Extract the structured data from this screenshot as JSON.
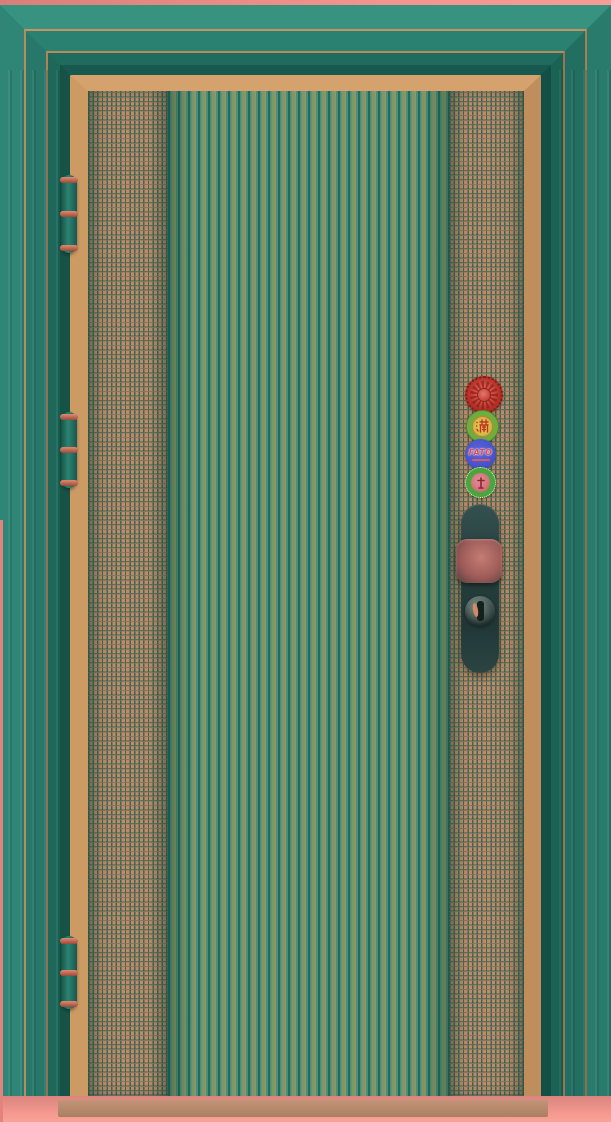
{
  "photo": {
    "subject": "Teal-tinted photograph of a closed bronze security door with ribbed center panel and perforated mesh side strips"
  },
  "door": {
    "panels": {
      "left": "perforated-mesh-strip",
      "center": "vertical-ribbed-panel",
      "right": "perforated-mesh-strip"
    },
    "hinges": [
      {
        "position": "top"
      },
      {
        "position": "middle"
      },
      {
        "position": "bottom"
      }
    ],
    "stickers": {
      "rosette": {
        "label": "red rosette seal"
      },
      "man_seal": {
        "character": "滿"
      },
      "fato": {
        "label": "FATO"
      },
      "cert": {
        "label": "green certification badge"
      }
    },
    "hardware": {
      "handle": "recessed pull plate with knob",
      "lock": "cylinder keyhole"
    }
  },
  "colors": {
    "teal_frame": "#2a7e6f",
    "frame_gap_shadow": "#134f45",
    "copper_trim": "#cc9b64",
    "mesh_copper": "#c08a66",
    "rib_olive": "#7f9768",
    "floor_pink": "#f59a90",
    "sticker_red": "#b63028",
    "sticker_green": "#6fae3e",
    "sticker_blue": "#4a52c9",
    "sticker_yellow": "#d9c353"
  }
}
